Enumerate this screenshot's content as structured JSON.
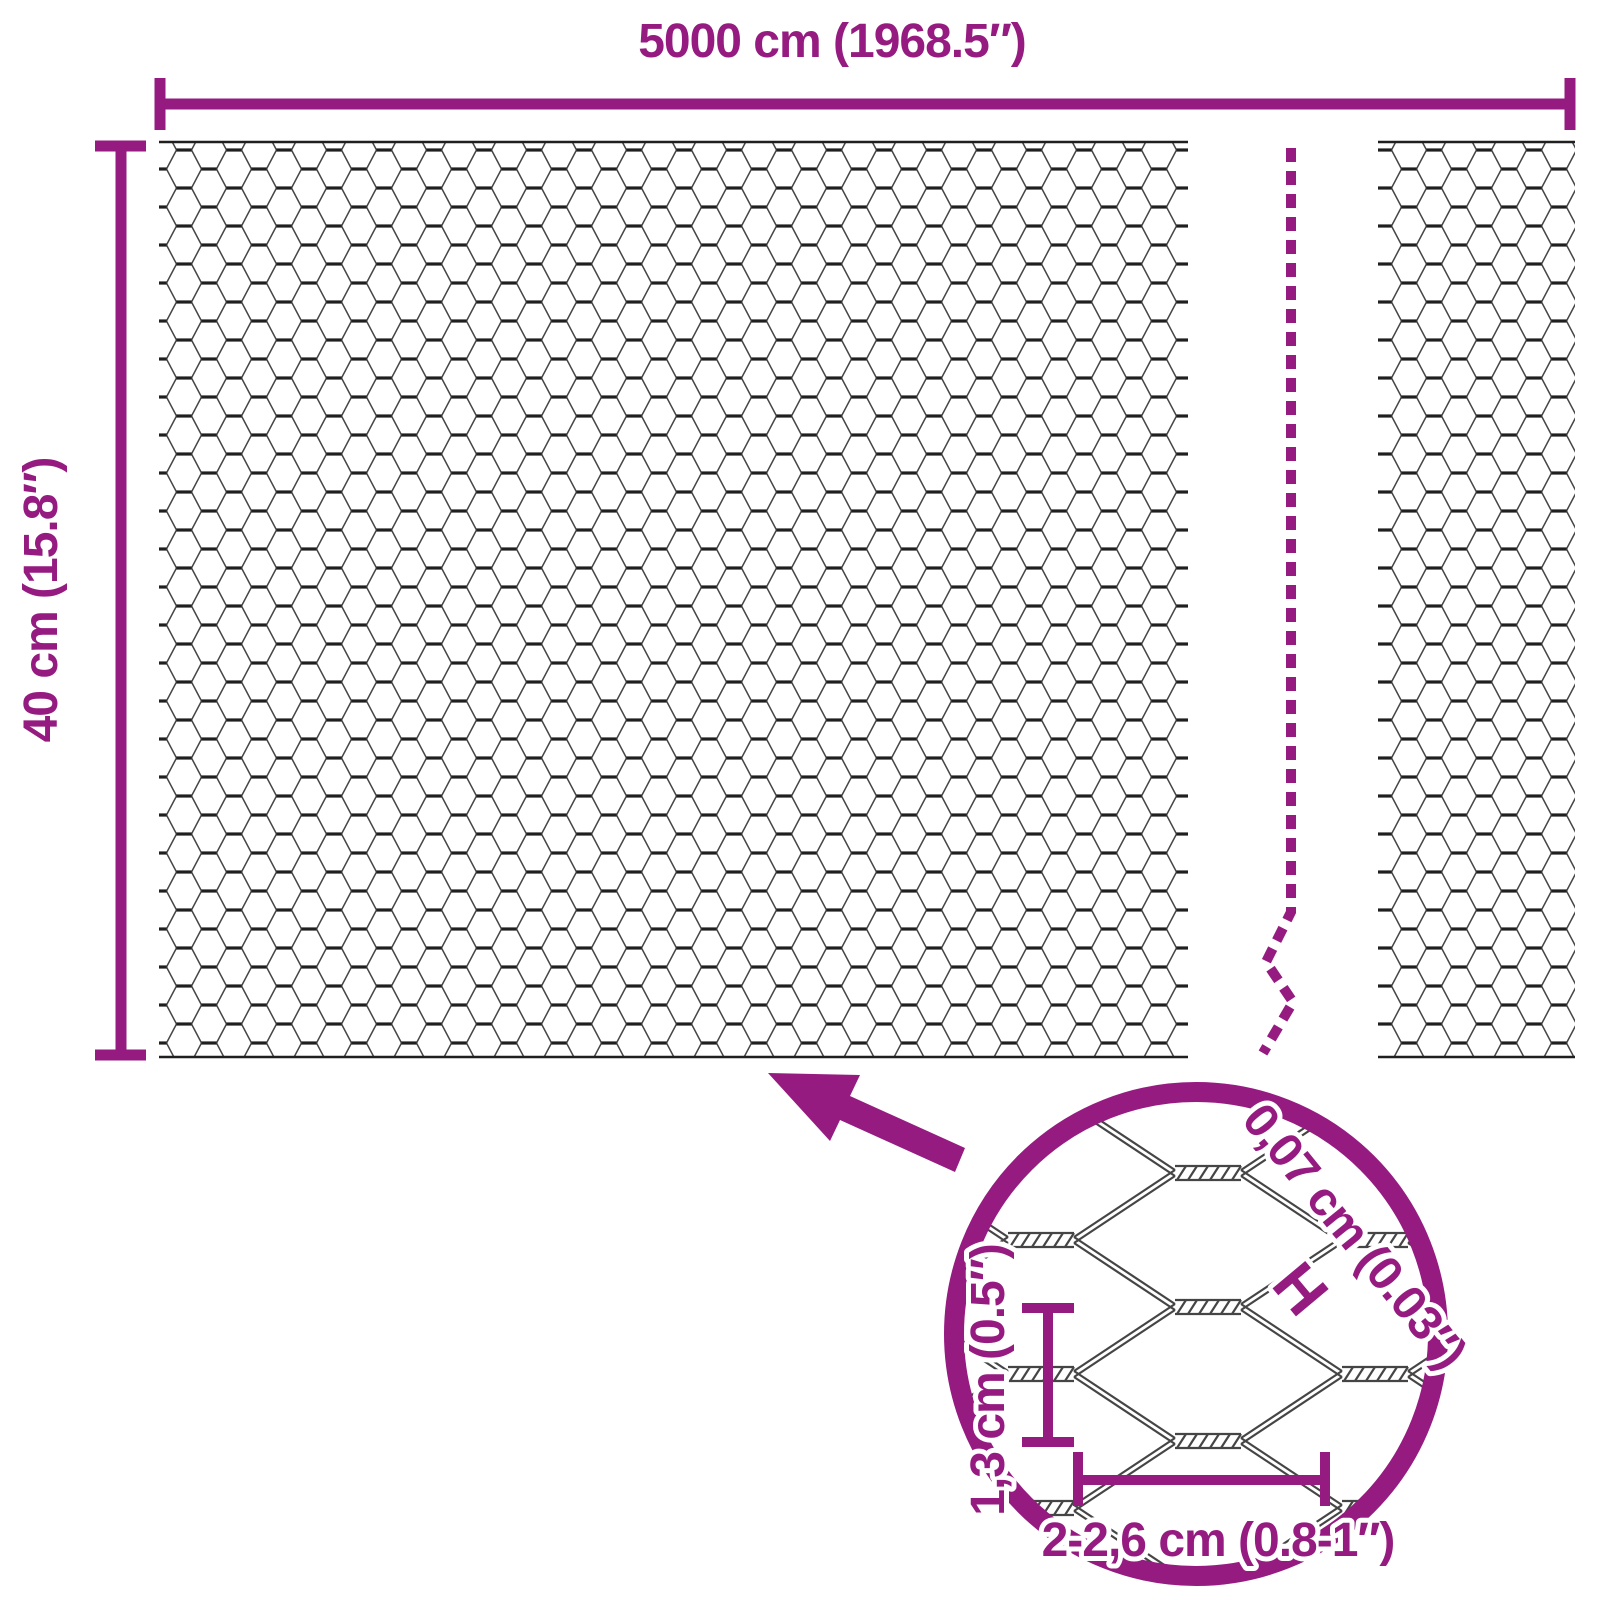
{
  "colors": {
    "accent": "#951B81",
    "wire": "#1f1f1f",
    "wire_light": "#454545",
    "background": "#ffffff"
  },
  "dimensions": {
    "length": {
      "label": "5000 cm (1968.5″)"
    },
    "height": {
      "label": "40 cm (15.8″)"
    }
  },
  "magnifier": {
    "wire_thickness": {
      "label": "0,07 cm (0.03″)",
      "symbol": "H"
    },
    "mesh_height": {
      "label": "1,3 cm (0.5″)"
    },
    "mesh_width": {
      "label": "2-2,6 cm (0.8-1″)"
    }
  }
}
